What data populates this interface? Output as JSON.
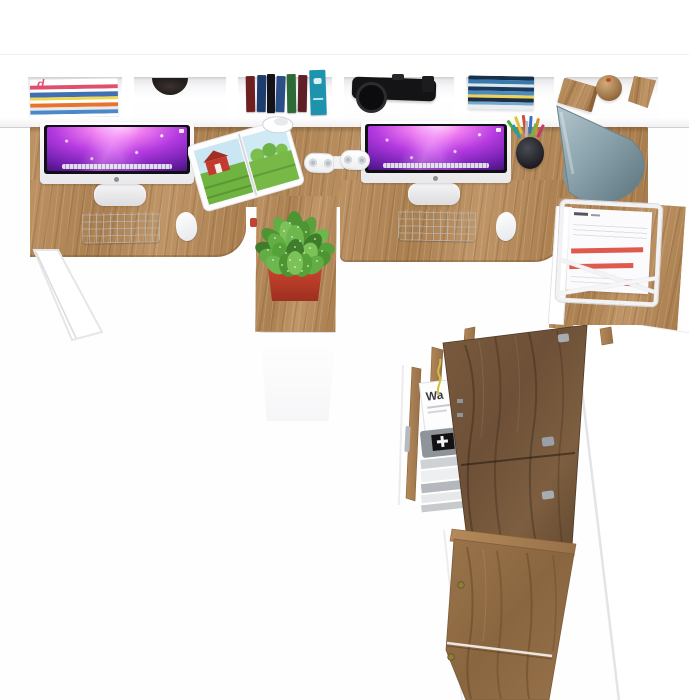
{
  "scene": {
    "router_box_label": "Wa",
    "magazine_masthead_letter": "d"
  },
  "colors": {
    "wood": "#b3895a",
    "wood-dark": "#6d5037",
    "white": "#ffffff",
    "pot-red": "#c0442f",
    "plant-green": "#63ad45",
    "lamp-gray": "#8aa3ad",
    "screen-violet": "#b43ae0",
    "paper-line-red": "#dd5a4c",
    "keyboard-white": "#f4f5f7"
  }
}
